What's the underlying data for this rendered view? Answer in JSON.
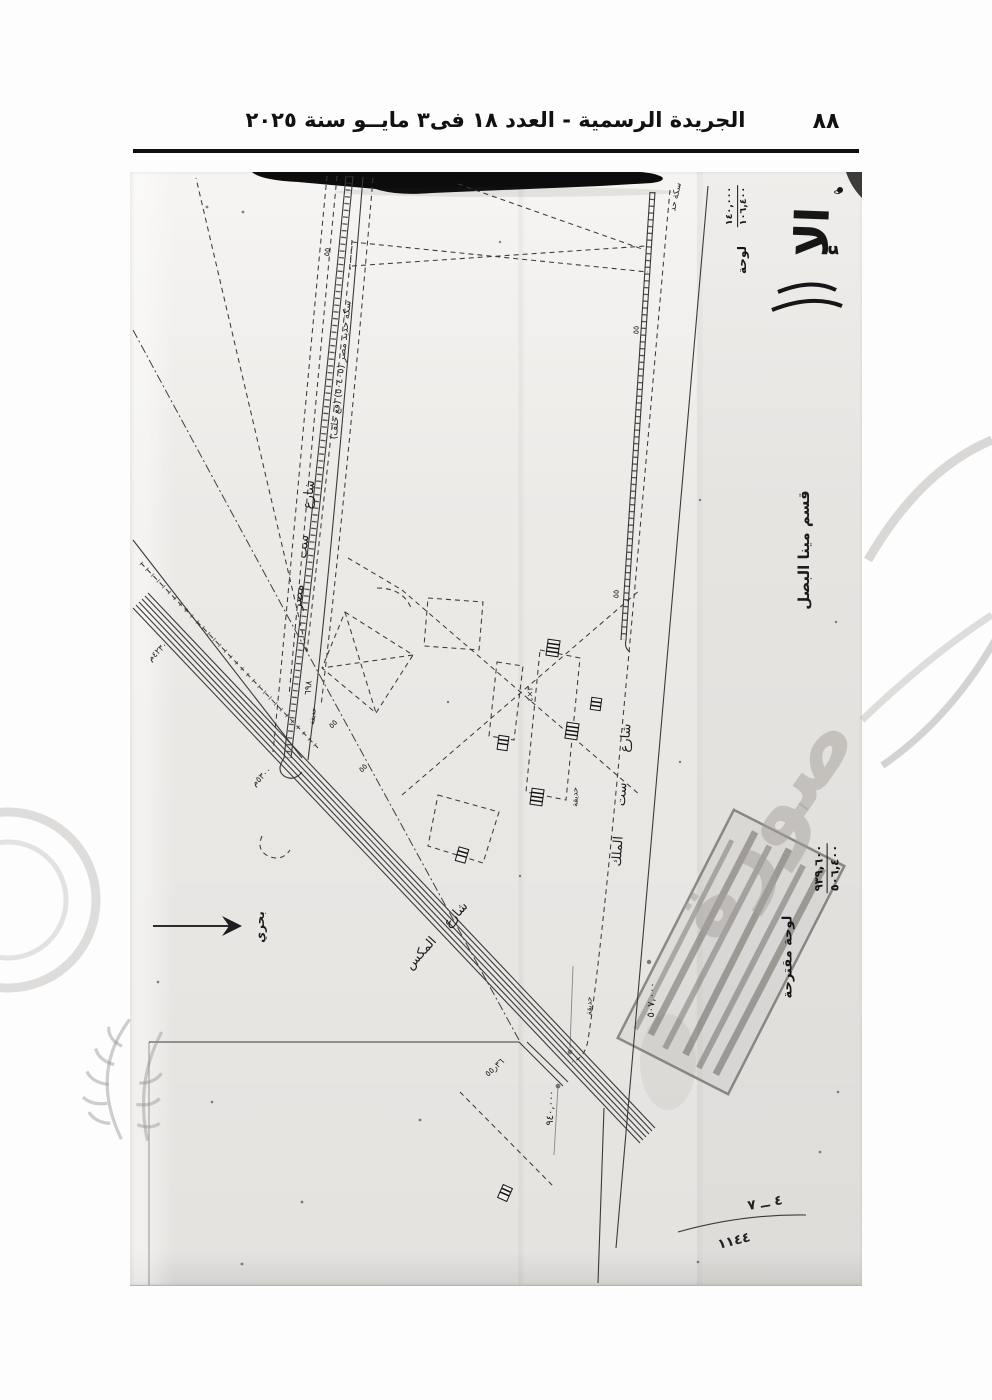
{
  "header": {
    "title": "الجريدة الرسمية - العدد ١٨ فى٣ مايــو سنة ٢٠٢٥",
    "page_number": "٨٨"
  },
  "map": {
    "corner_title": "الإ",
    "sheet": {
      "label": "لوحة",
      "num1": "١٤٠,٠٠٠",
      "num2": "١٠٦,٤٠٠"
    },
    "district": "قسم مينا البصل",
    "stamp": {
      "label": "لوحة مقترحة",
      "num1": "٩٣٩,٦٠٠",
      "num2": "٥٠٦,٤٠٠"
    },
    "reference": {
      "top": "٤ ــ ٧",
      "bottom": "١١٤٤"
    },
    "labels": [
      {
        "name": "district-label",
        "text": "قسم مينا البصل",
        "x": 804,
        "y": 550,
        "rot": -90,
        "size": 15,
        "bold": true
      },
      {
        "name": "street-sitt-elmalek",
        "text": "شارع ست الملك",
        "x": 622,
        "y": 795,
        "rot": -86,
        "size": 13,
        "ws": 26
      },
      {
        "name": "street-sitt-masr",
        "text": "شارع ست مصر",
        "x": 304,
        "y": 545,
        "rot": -84,
        "size": 13,
        "ws": 22
      },
      {
        "name": "railway-label",
        "text": "سكة حديد مصر (٥٠٤٠٥) (قع خلف)",
        "x": 341,
        "y": 370,
        "rot": -84,
        "size": 9.5
      },
      {
        "name": "street-almax",
        "text": "شارع المكس",
        "x": 437,
        "y": 936,
        "rot": -48,
        "size": 13,
        "ws": 14
      },
      {
        "name": "north-label",
        "text": "بحري",
        "x": 260,
        "y": 927,
        "rot": -90,
        "size": 12,
        "bold": true
      },
      {
        "name": "coord-507000",
        "text": "٥٠٧,٠٠٠",
        "x": 652,
        "y": 1000,
        "rot": -87,
        "size": 10
      },
      {
        "name": "coord-940000",
        "text": "٩٤٠,٠٠٠",
        "x": 551,
        "y": 1108,
        "rot": -87,
        "size": 10
      },
      {
        "name": "parcel-698",
        "text": "٦٩٨",
        "x": 309,
        "y": 688,
        "rot": -84,
        "size": 9
      },
      {
        "name": "garden-label-1",
        "text": "حديقة",
        "x": 575,
        "y": 797,
        "rot": -90,
        "size": 8
      },
      {
        "name": "garden-label-2",
        "text": "حديقة",
        "x": 589,
        "y": 1006,
        "rot": -90,
        "size": 7.5
      },
      {
        "name": "garden-label-3",
        "text": "حديقة",
        "x": 313,
        "y": 716,
        "rot": -84,
        "size": 7
      },
      {
        "name": "dim-3x4",
        "text": "٣×٤",
        "x": 530,
        "y": 694,
        "rot": -90,
        "size": 8
      },
      {
        "name": "mark-55-1",
        "text": "٥٥",
        "x": 327,
        "y": 252,
        "rot": -84,
        "size": 8
      },
      {
        "name": "mark-55-2",
        "text": "٥٥",
        "x": 636,
        "y": 330,
        "rot": -88,
        "size": 8
      },
      {
        "name": "mark-55-3",
        "text": "٥٥",
        "x": 616,
        "y": 594,
        "rot": -88,
        "size": 8
      },
      {
        "name": "mark-55-4",
        "text": "٥٥",
        "x": 333,
        "y": 724,
        "rot": -46,
        "size": 8
      },
      {
        "name": "mark-55-5",
        "text": "٥٥",
        "x": 363,
        "y": 768,
        "rot": -46,
        "size": 8
      },
      {
        "name": "rail-top-label",
        "text": "سكة حد",
        "x": 676,
        "y": 197,
        "rot": -78,
        "size": 8.5
      },
      {
        "name": "annotation-1",
        "text": "٤٢٣٠م",
        "x": 158,
        "y": 652,
        "rot": -44,
        "size": 8.5
      },
      {
        "name": "annotation-2",
        "text": "٥٣٠٠م",
        "x": 262,
        "y": 777,
        "rot": -44,
        "size": 8.5
      },
      {
        "name": "junction-annotation",
        "text": "٣٦ر٥٥",
        "x": 495,
        "y": 1068,
        "rot": -42,
        "size": 8.5
      },
      {
        "name": "corner-mark",
        "text": "٥",
        "x": 838,
        "y": 192,
        "rot": -90,
        "size": 10
      }
    ]
  },
  "watermark": {
    "text": "صورة"
  }
}
